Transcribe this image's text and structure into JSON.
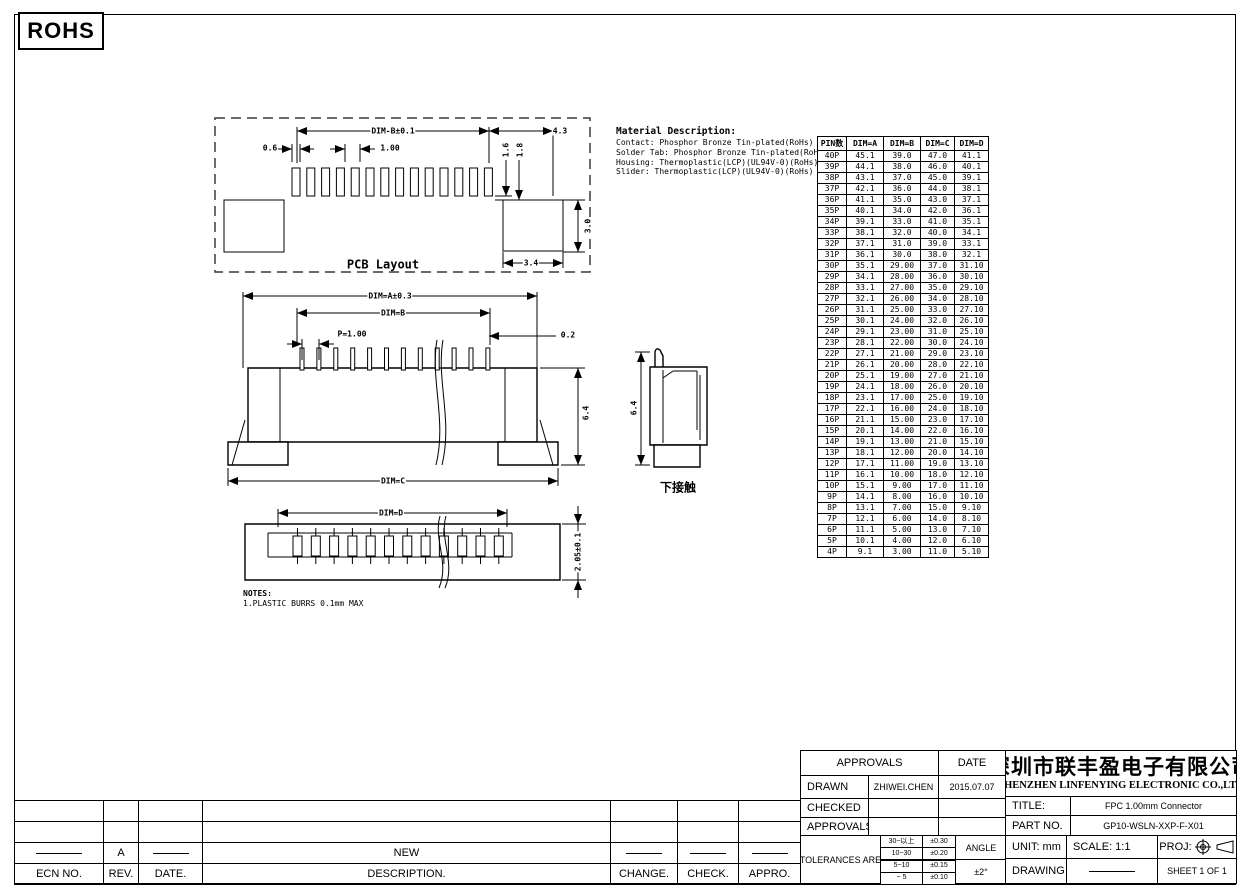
{
  "rohs_label": "ROHS",
  "material": {
    "title": "Material Description:",
    "lines": [
      "Contact: Phosphor Bronze Tin-plated(RoHs)",
      "Solder Tab: Phosphor Bronze Tin-plated(RoHs)",
      "Housing: Thermoplastic(LCP)(UL94V-0)(RoHs)",
      "Slider: Thermoplastic(LCP)(UL94V-0)(RoHs)"
    ]
  },
  "pcb_view": {
    "label": "PCB Layout",
    "dim_top": "DIM-B±0.1",
    "dim_top_right": "4.3",
    "dim_left": "0.6",
    "dim_pitch": "1.00",
    "dim_v1": "1.6",
    "dim_v2": "1.8",
    "dim_height": "3.0",
    "dim_bottom": "3.4"
  },
  "front_view": {
    "dim_overall": "DIM=A±0.3",
    "dim_inner": "DIM=B",
    "dim_pitch": "P=1.00",
    "dim_pin": "0.2",
    "dim_height": "6.4",
    "dim_bottom": "DIM=C"
  },
  "side_view": {
    "dim_height": "6.4",
    "label": "下接触"
  },
  "bottom_view": {
    "dim_top": "DIM=D",
    "dim_height": "2.05±0.1"
  },
  "notes": {
    "title": "NOTES:",
    "lines": [
      "1.PLASTIC BURRS 0.1mm MAX"
    ]
  },
  "dim_table": {
    "headers": [
      "PIN数",
      "DIM=A",
      "DIM=B",
      "DIM=C",
      "DIM=D"
    ],
    "rows": [
      [
        "40P",
        "45.1",
        "39.0",
        "47.0",
        "41.1"
      ],
      [
        "39P",
        "44.1",
        "38.0",
        "46.0",
        "40.1"
      ],
      [
        "38P",
        "43.1",
        "37.0",
        "45.0",
        "39.1"
      ],
      [
        "37P",
        "42.1",
        "36.0",
        "44.0",
        "38.1"
      ],
      [
        "36P",
        "41.1",
        "35.0",
        "43.0",
        "37.1"
      ],
      [
        "35P",
        "40.1",
        "34.0",
        "42.0",
        "36.1"
      ],
      [
        "34P",
        "39.1",
        "33.0",
        "41.0",
        "35.1"
      ],
      [
        "33P",
        "38.1",
        "32.0",
        "40.0",
        "34.1"
      ],
      [
        "32P",
        "37.1",
        "31.0",
        "39.0",
        "33.1"
      ],
      [
        "31P",
        "36.1",
        "30.0",
        "38.0",
        "32.1"
      ],
      [
        "30P",
        "35.1",
        "29.00",
        "37.0",
        "31.10"
      ],
      [
        "29P",
        "34.1",
        "28.00",
        "36.0",
        "30.10"
      ],
      [
        "28P",
        "33.1",
        "27.00",
        "35.0",
        "29.10"
      ],
      [
        "27P",
        "32.1",
        "26.00",
        "34.0",
        "28.10"
      ],
      [
        "26P",
        "31.1",
        "25.00",
        "33.0",
        "27.10"
      ],
      [
        "25P",
        "30.1",
        "24.00",
        "32.0",
        "26.10"
      ],
      [
        "24P",
        "29.1",
        "23.00",
        "31.0",
        "25.10"
      ],
      [
        "23P",
        "28.1",
        "22.00",
        "30.0",
        "24.10"
      ],
      [
        "22P",
        "27.1",
        "21.00",
        "29.0",
        "23.10"
      ],
      [
        "21P",
        "26.1",
        "20.00",
        "28.0",
        "22.10"
      ],
      [
        "20P",
        "25.1",
        "19.00",
        "27.0",
        "21.10"
      ],
      [
        "19P",
        "24.1",
        "18.00",
        "26.0",
        "20.10"
      ],
      [
        "18P",
        "23.1",
        "17.00",
        "25.0",
        "19.10"
      ],
      [
        "17P",
        "22.1",
        "16.00",
        "24.0",
        "18.10"
      ],
      [
        "16P",
        "21.1",
        "15.00",
        "23.0",
        "17.10"
      ],
      [
        "15P",
        "20.1",
        "14.00",
        "22.0",
        "16.10"
      ],
      [
        "14P",
        "19.1",
        "13.00",
        "21.0",
        "15.10"
      ],
      [
        "13P",
        "18.1",
        "12.00",
        "20.0",
        "14.10"
      ],
      [
        "12P",
        "17.1",
        "11.00",
        "19.0",
        "13.10"
      ],
      [
        "11P",
        "16.1",
        "10.00",
        "18.0",
        "12.10"
      ],
      [
        "10P",
        "15.1",
        "9.00",
        "17.0",
        "11.10"
      ],
      [
        "9P",
        "14.1",
        "8.00",
        "16.0",
        "10.10"
      ],
      [
        "8P",
        "13.1",
        "7.00",
        "15.0",
        "9.10"
      ],
      [
        "7P",
        "12.1",
        "6.00",
        "14.0",
        "8.10"
      ],
      [
        "6P",
        "11.1",
        "5.00",
        "13.0",
        "7.10"
      ],
      [
        "5P",
        "10.1",
        "4.00",
        "12.0",
        "6.10"
      ],
      [
        "4P",
        "9.1",
        "3.00",
        "11.0",
        "5.10"
      ]
    ]
  },
  "revision_table": {
    "headers": [
      "ECN NO.",
      "REV.",
      "DATE.",
      "DESCRIPTION.",
      "CHANGE.",
      "CHECK.",
      "APPRO."
    ],
    "new_row": {
      "rev": "A",
      "description": "NEW"
    }
  },
  "title_block": {
    "approvals_header": "APPROVALS",
    "date_header": "DATE",
    "drawn_label": "DRAWN",
    "drawn_name": "ZHIWEI.CHEN",
    "drawn_date": "2015.07.07",
    "checked_label": "CHECKED",
    "approvals_label": "APPROVALS",
    "tolerances_label": "TOLERANCES  ARE",
    "tolerance_rows": [
      [
        "30~以上",
        "±0.30"
      ],
      [
        "10~30",
        "±0.20"
      ],
      [
        "5~10",
        "±0.15"
      ],
      [
        "~ 5",
        "±0.10"
      ]
    ],
    "angle_label": "ANGLE",
    "angle_value": "±2°",
    "company_cn": "深圳市联丰盈电子有限公司",
    "company_en": "SHENZHEN LINFENYING ELECTRONIC CO.,LTD",
    "title_label": "TITLE:",
    "title_value": "FPC  1.00mm   Connector",
    "part_label": "PART  NO.",
    "part_value": "GP10-WSLN-XXP-F-X01",
    "unit_label": "UNIT:  mm",
    "scale_label": "SCALE:    1:1",
    "proj_label": "PROJ:",
    "drawing_label": "DRAWING  NO.",
    "sheet_label": "SHEET   1  OF  1"
  }
}
